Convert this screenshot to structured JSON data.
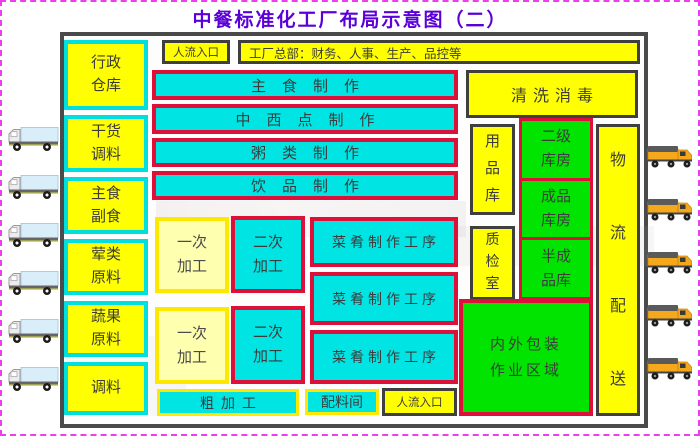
{
  "title": "中餐标准化工厂布局示意图（二）",
  "top_bar": {
    "entrance_label": "人流入口",
    "headquarters_label": "工厂总部：财务、人事、生产、品控等"
  },
  "storage_column": [
    {
      "label": "行政\n仓库"
    },
    {
      "label": "干货\n调料"
    },
    {
      "label": "主食\n副食"
    },
    {
      "label": "荤类\n原料"
    },
    {
      "label": "蔬果\n原料"
    },
    {
      "label": "调料"
    }
  ],
  "production_lines": [
    {
      "label": "主食制作"
    },
    {
      "label": "中西点制作"
    },
    {
      "label": "粥类制作"
    },
    {
      "label": "饮品制作"
    }
  ],
  "processing": {
    "primary_1": "一次\n加工",
    "secondary_1": "二次\n加工",
    "primary_2": "一次\n加工",
    "secondary_2": "二次\n加工",
    "dish_lines": [
      {
        "label": "菜肴制作工序"
      },
      {
        "label": "菜肴制作工序"
      },
      {
        "label": "菜肴制作工序"
      }
    ],
    "rough_processing": "粗加工",
    "ingredients_room": "配料间",
    "entrance_label": "人流入口"
  },
  "right_zone": {
    "cleaning": "清洗消毒",
    "supplies_store": "用\n品\n库",
    "secondary_warehouse": "二级\n库房",
    "finished_warehouse": "成品\n库房",
    "qc_room": "质\n检\n室",
    "semi_finished_warehouse": "半成\n品库",
    "packaging_area": "内外包装\n作业区域",
    "logistics": "物\n流\n配\n送"
  },
  "icons": {
    "left_trucks": {
      "name": "delivery-truck-icon",
      "count": 6,
      "direction": "left"
    },
    "right_trucks": {
      "name": "delivery-truck-icon",
      "count": 5,
      "direction": "right"
    }
  },
  "colors": {
    "title_text": "#5b00d8",
    "yellow_fill": "#ffff00",
    "cyan_fill": "#00e4e4",
    "green_fill": "#00e400",
    "pale_yellow_fill": "#ffffb0",
    "red_border": "#dc1038",
    "cyan_border": "#00dede",
    "yellow_border": "#ffe800",
    "dark_border": "#3f3f3f",
    "slide_dashed_border": "#ee3cee"
  }
}
